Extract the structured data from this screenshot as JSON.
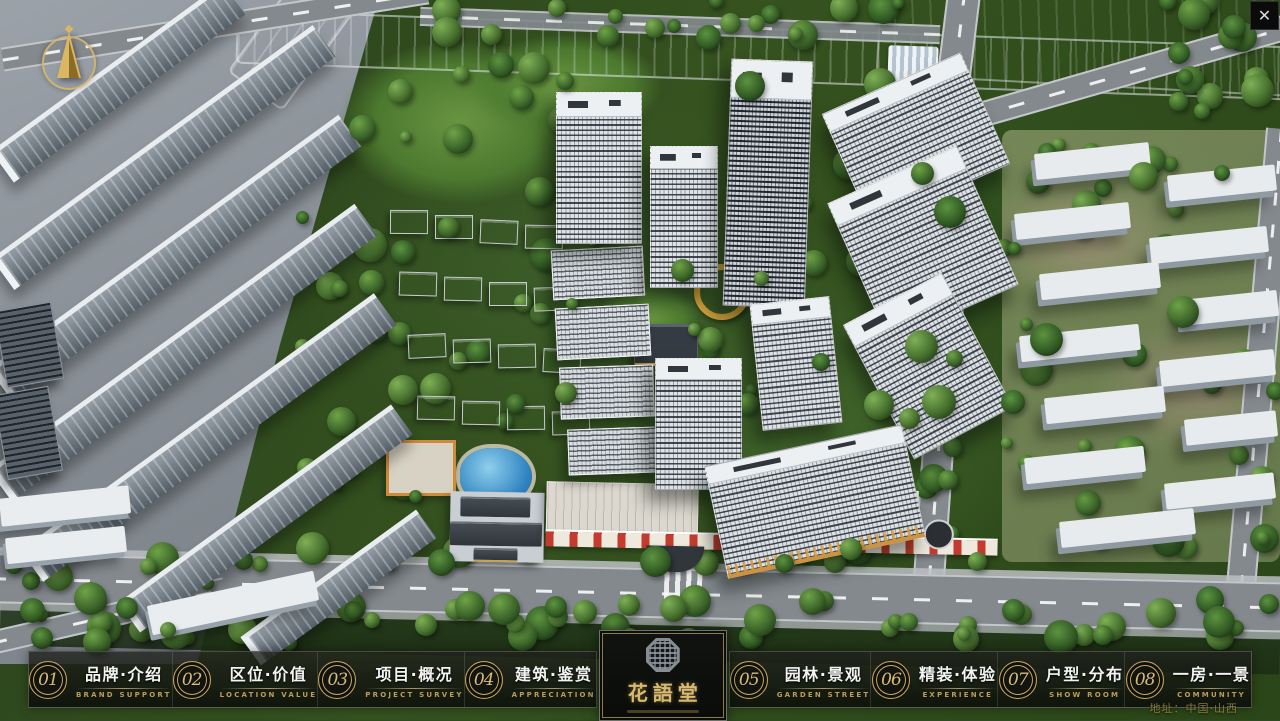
{
  "header": {
    "close_label": "✕"
  },
  "logo": {
    "name": "花語堂"
  },
  "nav": {
    "items": [
      {
        "num": "01",
        "zh": "品牌·介绍",
        "en": "BRAND SUPPORT"
      },
      {
        "num": "02",
        "zh": "区位·价值",
        "en": "LOCATION VALUE"
      },
      {
        "num": "03",
        "zh": "项目·概况",
        "en": "PROJECT SURVEY"
      },
      {
        "num": "04",
        "zh": "建筑·鉴赏",
        "en": "APPRECIATION"
      },
      {
        "num": "05",
        "zh": "园林·景观",
        "en": "GARDEN STREET"
      },
      {
        "num": "06",
        "zh": "精装·体验",
        "en": "EXPERIENCE"
      },
      {
        "num": "07",
        "zh": "户型·分布",
        "en": "SHOW ROOM"
      },
      {
        "num": "08",
        "zh": "一房·一景",
        "en": "COMMUNITY"
      }
    ]
  },
  "footer": {
    "address": "地址：中国·山西"
  },
  "colors": {
    "gold": "#c9a96a",
    "nav_bg": "#0e100d",
    "river_blue": "#2f7fb5",
    "tree_green": "#3f6b2a",
    "road_grey": "#85898d",
    "building_white": "#e8ecef",
    "accent_red": "#b03a30",
    "lawn_green": "#5f8f3c"
  }
}
